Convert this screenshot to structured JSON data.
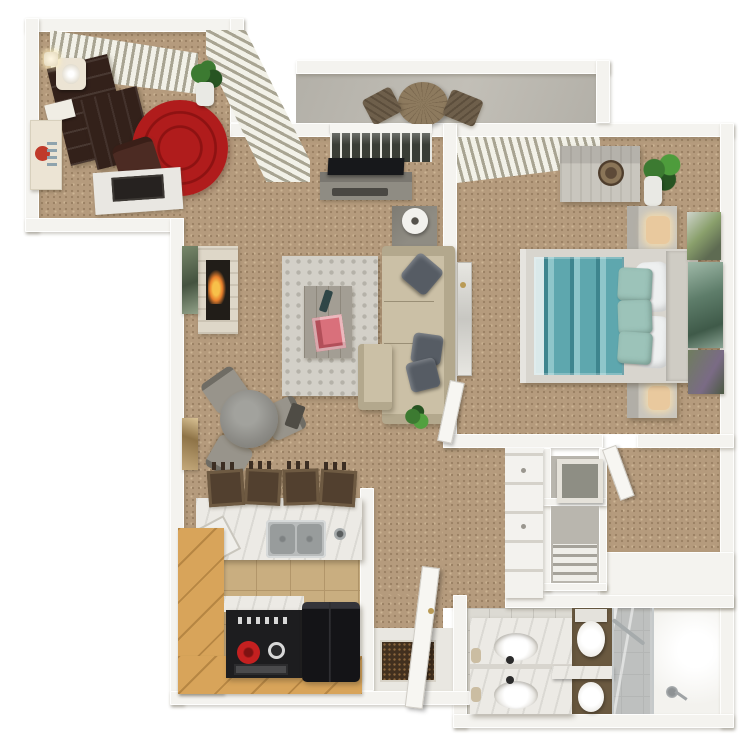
{
  "scene": {
    "type": "3d-rendered-floor-plan",
    "view": "top-down",
    "layout": "one-bedroom apartment, L-shaped, den wing upper-left, patio top-center, bedroom right, kitchen lower-left, bathroom lower-right"
  },
  "rooms": {
    "den": {
      "items": [
        "window-blinds-top",
        "window-blinds-side",
        "espresso-bookshelf",
        "table-lamp",
        "book-stack",
        "round-red-rug",
        "office-chair",
        "desk",
        "monitor",
        "potted-plant",
        "framed-wall-art",
        "wall-sconce"
      ]
    },
    "patio": {
      "items": [
        "concrete-floor",
        "round-wood-table",
        "patio-chair-left",
        "patio-chair-right"
      ]
    },
    "living_room": {
      "items": [
        "sliding-glass-door",
        "tv",
        "tv-console",
        "soundbar",
        "side-table",
        "cylinder-lamp",
        "fireplace",
        "flame",
        "green-wall-art",
        "tan-wall-art",
        "area-rug",
        "coffee-table",
        "remote-control",
        "pink-magazine",
        "beige-sectional-sofa",
        "chaise",
        "throw-pillows",
        "floor-plant"
      ]
    },
    "dining_nook": {
      "items": [
        "round-glass-table",
        "upholstered-chair-nw",
        "upholstered-chair-e",
        "upholstered-chair-sw"
      ]
    },
    "kitchen": {
      "items": [
        "marble-breakfast-bar",
        "double-sink",
        "faucet",
        "cutting-board",
        "bar-stools-x4",
        "oak-cabinet-run",
        "oak-cabinet-base",
        "range-stove",
        "red-burner-knob",
        "refrigerator",
        "tile-floor"
      ]
    },
    "entry": {
      "items": [
        "tile-floor",
        "speckled-doormat",
        "open-front-door",
        "door-knob"
      ]
    },
    "hall_closets": {
      "items": [
        "hallway-carpet",
        "linen-closet-drawers",
        "cubby-with-box",
        "cubby-with-shelf",
        "walk-in-closet",
        "closet-door"
      ]
    },
    "bedroom": {
      "items": [
        "window-blinds",
        "concrete-dresser",
        "hat-box",
        "potted-plant",
        "nightstand-top",
        "nightstand-bottom",
        "table-lamps",
        "bed-frame",
        "teal-striped-duvet",
        "white-pillows",
        "teal-accent-pillows",
        "headboard",
        "leaning-mirror",
        "bedroom-door",
        "photo-collage-art"
      ]
    },
    "bathroom": {
      "items": [
        "marble-double-vanity",
        "oval-sink-top",
        "oval-sink-bottom",
        "black-faucets",
        "towel-rolls",
        "toilet",
        "marble-half-wall",
        "oval-fixture",
        "glass-shower-panel",
        "chrome-towel-bar",
        "shower-floor",
        "shower-head"
      ]
    }
  },
  "colors": {
    "wall": "#f4f3ef",
    "wall-shade": "#d9d6ce",
    "carpet": "#b59b7d",
    "carpet-dark": "#9a8164",
    "carpet-light": "#cbb393",
    "patio-concrete": "#b3b0a8",
    "red-rug": "#b01c1c",
    "red-rug-dark": "#8e1212",
    "espresso": "#33211a",
    "cream": "#ece4d4",
    "den-chair": "#4c2b23",
    "desk-white": "#e9e7e2",
    "monitor": "#262220",
    "blind-light": "#f2f1e8",
    "blind-gap": "#a8a492",
    "area-rug": "#d3d0c8",
    "area-rug-dot": "#b5b2a9",
    "coffee-table": "#a39e94",
    "remote": "#2f4647",
    "magazine": "#d9707b",
    "sofa": "#cbc0a6",
    "sofa-edge": "#b3a88d",
    "pillow-dark": "#565c64",
    "fire-stone": "#ded7c8",
    "firebox": "#211d18",
    "flame": "#e87f2c",
    "art-green-1": "#77876a",
    "art-green-2": "#44523f",
    "art-tan-1": "#c4a97b",
    "art-tan-2": "#8e7347",
    "table-gray": "#8c8b86",
    "chair-gray": "#98948b",
    "tv-black": "#17181b",
    "console": "#8f8c83",
    "glass-dark": "#3a3d36",
    "lamp-white": "#f2f1ed",
    "bed-frame": "#d8d5ce",
    "duvet": "#5ea7ae",
    "duvet-dark": "#3e858e",
    "duvet-light": "#8ec6ca",
    "pillow-white": "#eef0f0",
    "pillow-teal": "#9cc3b9",
    "headboard": "#cfccc4",
    "concrete-furn": "#c9c6be",
    "concrete-dark": "#a8a59d",
    "lamp-peach": "#e9c99e",
    "collage-a1": "#8aa06c",
    "collage-a2": "#cfd4cc",
    "collage-b1": "#5e7d6a",
    "collage-b2": "#9fb9a8",
    "collage-c1": "#6f7d5e",
    "collage-c2": "#7a6b85",
    "oak": "#d8a45a",
    "ktile": "#c9ae80",
    "ktile-grout": "#b2966a",
    "stove": "#1d1d1f",
    "burner-red": "#c42020",
    "fridge": "#141417",
    "stool": "#52402f",
    "stool-light": "#6e5a42",
    "counter-marble": "#eceae5",
    "sink-steel": "#b9bcbc",
    "sink-basin": "#989c9c",
    "btile": "#dcdad3",
    "btile-grout": "#c6c4bd",
    "dark-tile": "#6a5940",
    "porcelain": "#f3f2ee",
    "chrome": "#a6abac",
    "doormat": "#42301f",
    "doormat-fleck": "#8a653c",
    "door-white": "#f7f6f2",
    "knob-gold": "#b99a55",
    "box-gray": "#8e8e84",
    "cubby-floor": "#b9b6ae",
    "plant-green": "#3c7a31",
    "plant-dark": "#275422",
    "pot-white": "#e9e9e4",
    "patio-wood": "#8d7a5e",
    "patio-chair": "#6e5f4b"
  }
}
